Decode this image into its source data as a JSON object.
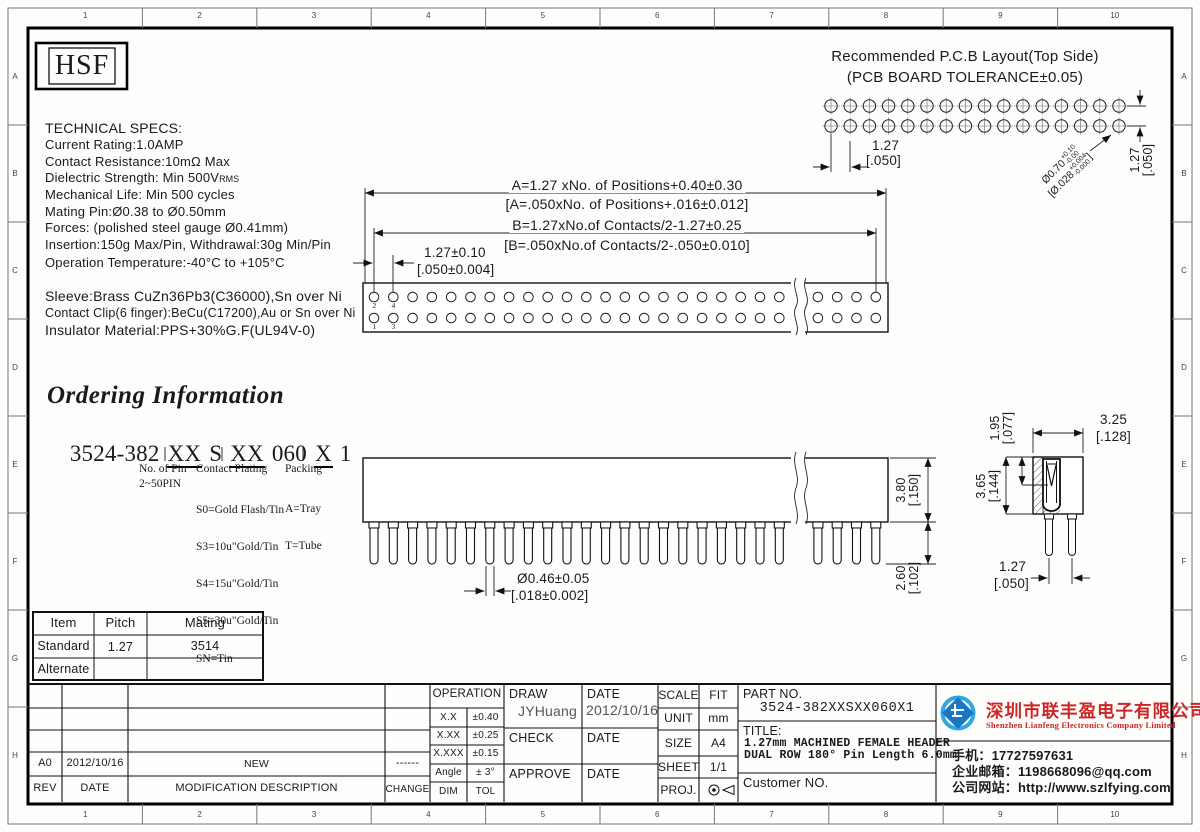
{
  "frame": {
    "cols": [
      "1",
      "2",
      "3",
      "4",
      "5",
      "6",
      "7",
      "8",
      "9",
      "10"
    ],
    "rows": [
      "A",
      "B",
      "C",
      "D",
      "E",
      "F",
      "G",
      "H"
    ]
  },
  "logo": {
    "text": "HSF"
  },
  "specs": {
    "title": "TECHNICAL SPECS:",
    "lines": [
      "Current Rating:1.0AMP",
      "Contact Resistance:10mΩ Max",
      "Dielectric Strength: Min 500V",
      "Mechanical Life: Min 500 cycles",
      "Mating Pin:Ø0.38 to Ø0.50mm",
      "Forces: (polished steel gauge Ø0.41mm)",
      "Insertion:150g Max/Pin, Withdrawal:30g Min/Pin",
      "Operation Temperature:-40°C to +105°C"
    ],
    "vrms_suffix": "RMS",
    "materials": [
      "Sleeve:Brass CuZn36Pb3(C36000),Sn over Ni",
      "Contact Clip(6 finger):BeCu(C17200),Au or Sn over Ni",
      "Insulator Material:PPS+30%G.F(UL94V-0)"
    ]
  },
  "pcb": {
    "title": "Recommended P.C.B Layout(Top Side)",
    "subtitle": "(PCB BOARD TOLERANCE±0.05)",
    "pitch_mm": "1.27",
    "pitch_in": "[.050]",
    "row_pitch_mm": "1.27",
    "row_pitch_in": "[.050]",
    "hole_mm": {
      "base": "Ø0.70",
      "plus": "+0.10",
      "minus": "-0.00"
    },
    "hole_in": {
      "open": "[",
      "base": "Ø.028",
      "plus": "+0.004",
      "minus": "-0.000",
      "close": "]"
    }
  },
  "dims": {
    "formula_a_mm": "A=1.27 xNo. of Positions+0.40±0.30",
    "formula_a_in": "[A=.050xNo. of Positions+.016±0.012]",
    "formula_b_mm": "B=1.27xNo.of Contacts/2-1.27±0.25",
    "formula_b_in": "[B=.050xNo.of Contacts/2-.050±0.010]",
    "pitch_mm": "1.27±0.10",
    "pitch_in": "[.050±0.004]",
    "pin_dia_mm": "Ø0.46±0.05",
    "pin_dia_in": "[.018±0.002]",
    "body_h_mm": "3.80",
    "body_h_in": "[.150]",
    "pin_len_mm": "2.60",
    "pin_len_in": "[.102]",
    "depth_mm": "1.95",
    "depth_in": "[.077]",
    "ins_h_mm": "3.65",
    "ins_h_in": "[.144]",
    "width_mm": "3.25",
    "width_in": "[.128]",
    "sec_pitch_mm": "1.27",
    "sec_pitch_in": "[.050]",
    "pin_labels": {
      "p1": "1",
      "p2": "2",
      "p3": "3",
      "p4": "4"
    }
  },
  "ordering": {
    "title": "Ordering Information",
    "code": {
      "prefix": "3524-382",
      "pin": "XX",
      "series": "S",
      "plating": "XX",
      "length": "060",
      "packing": "X",
      "suffix": "1"
    },
    "pin_title": "No. of Pin",
    "pin_range": "2~50PIN",
    "plating_title": "Contact Plating",
    "plating_options": [
      "S0=Gold Flash/Tin",
      "S3=10u\"Gold/Tin",
      "S4=15u\"Gold/Tin",
      "S5=30u\"Gold/Tin",
      "SN=Tin"
    ],
    "packing_title": "Packing",
    "packing_options": [
      "A=Tray",
      "T=Tube"
    ]
  },
  "mating_table": {
    "headers": [
      "Item",
      "Pitch",
      "Mating"
    ],
    "rows": [
      [
        "Standard",
        "1.27",
        "3514"
      ],
      [
        "Alternate",
        "",
        ""
      ]
    ]
  },
  "revision": {
    "headers": [
      "REV",
      "DATE",
      "MODIFICATION DESCRIPTION",
      "CHANGE"
    ],
    "entry": {
      "rev": "A0",
      "date": "2012/10/16",
      "desc": "NEW",
      "change": "------"
    }
  },
  "operation": {
    "header": "OPERATION",
    "rows": [
      [
        "X.X",
        "±0.40"
      ],
      [
        "X.XX",
        "±0.25"
      ],
      [
        "X.XXX",
        "±0.15"
      ],
      [
        "Angle",
        "± 3°"
      ]
    ],
    "footer": [
      "DIM",
      "TOL"
    ]
  },
  "sign": {
    "draw": "DRAW",
    "date": "DATE",
    "check": "CHECK",
    "approve": "APPROVE",
    "draw_name": "JYHuang",
    "draw_date": "2012/10/16"
  },
  "meta": {
    "scale_label": "SCALE",
    "scale": "FIT",
    "unit_label": "UNIT",
    "unit": "mm",
    "size_label": "SIZE",
    "size": "A4",
    "sheet_label": "SHEET",
    "sheet": "1/1",
    "proj_label": "PROJ."
  },
  "part": {
    "label": "PART NO.",
    "number": "3524-382XXSXX060X1",
    "title_label": "TITLE:",
    "title_line1": "1.27mm MACHINED FEMALE HEADER",
    "title_line2": "DUAL ROW 180° Pin Length 6.0mm",
    "customer_label": "Customer NO."
  },
  "company": {
    "name_cn": "深圳市联丰盈电子有限公司",
    "name_en": "Shenzhen Lianfeng Electronics Company Limited",
    "phone": "手机：17727597631",
    "email": "企业邮箱：1198668096@qq.com",
    "website": "公司网站：http://www.szlfying.com"
  },
  "colors": {
    "accent_red": "#cd2626",
    "logo_blue": "#1b77c2",
    "logo_light_blue": "#2fa8e1",
    "line": "#111111"
  },
  "drawing": {
    "pcb_holes_per_row": 16,
    "pcb_rows": 2,
    "top_view_holes_per_row": 27,
    "top_view_rows": 2,
    "front_pins": 27,
    "front_break_index": 22,
    "section_pins": 2
  }
}
